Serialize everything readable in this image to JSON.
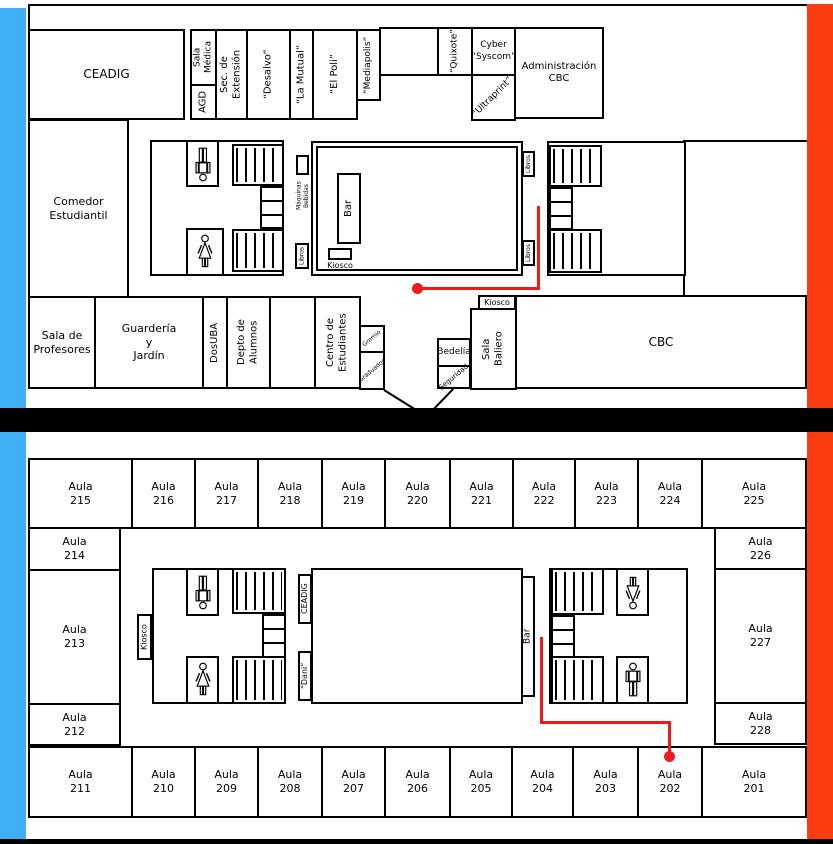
{
  "colors": {
    "blue_bar": "#41AFF6",
    "orange_bar": "#FB3D0F",
    "route_red": "#ED1C1C",
    "wall": "#000000"
  },
  "floor1": {
    "rooms": {
      "ceadig": "CEADIG",
      "sala_medica": "Sala\nMédica",
      "agd": "AGD",
      "sec_extension": "Sec. de\nExtensión",
      "desalvo": "“Desalvo”",
      "la_mutual": "“La Mutual”",
      "el_poli": "“El Poli”",
      "mediapolis": "“Mediapolis”",
      "quixote": "“Quixote”",
      "cyber_syscom": "Cyber\n“Syscom”",
      "ultraprint": "“Ultraprint”",
      "administracion_cbc": "Administración\nCBC",
      "comedor": "Comedor\nEstudiantil",
      "sala_profesores": "Sala de\nProfesores",
      "guarderia": "Guardería\ny\nJardín",
      "dosuba": "DosUBA",
      "depto_alumnos": "Depto de\nAlumnos",
      "centro_estudiantes": "Centro de\nEstudiantes",
      "gremio": "Gremio",
      "graduados": "Graduados",
      "bedelia": "Bedelía",
      "seguridad": "Seguridad",
      "kiosco_baliero": "Kiosco",
      "sala_baliero": "Sala\nBaliero",
      "cbc": "CBC",
      "bar": "Bar",
      "kiosco_patio": "Kiosco",
      "maquinas": "Máquinas\nBebidas",
      "libros": "Libros"
    }
  },
  "floor2": {
    "aulas_top": [
      "Aula\n215",
      "Aula\n216",
      "Aula\n217",
      "Aula\n218",
      "Aula\n219",
      "Aula\n220",
      "Aula\n221",
      "Aula\n222",
      "Aula\n223",
      "Aula\n224",
      "Aula\n225"
    ],
    "aulas_left": [
      "Aula\n214",
      "Aula\n213",
      "Aula\n212"
    ],
    "aulas_right": [
      "Aula\n226",
      "Aula\n227",
      "Aula\n228"
    ],
    "aulas_bottom": [
      "Aula\n211",
      "Aula\n210",
      "Aula\n209",
      "Aula\n208",
      "Aula\n207",
      "Aula\n206",
      "Aula\n205",
      "Aula\n204",
      "Aula\n203",
      "Aula\n202",
      "Aula\n201"
    ],
    "labels": {
      "kiosco": "Kiosco",
      "ceadig": "CEADIG",
      "dani": "“Dani”",
      "bar": "Bar"
    }
  }
}
